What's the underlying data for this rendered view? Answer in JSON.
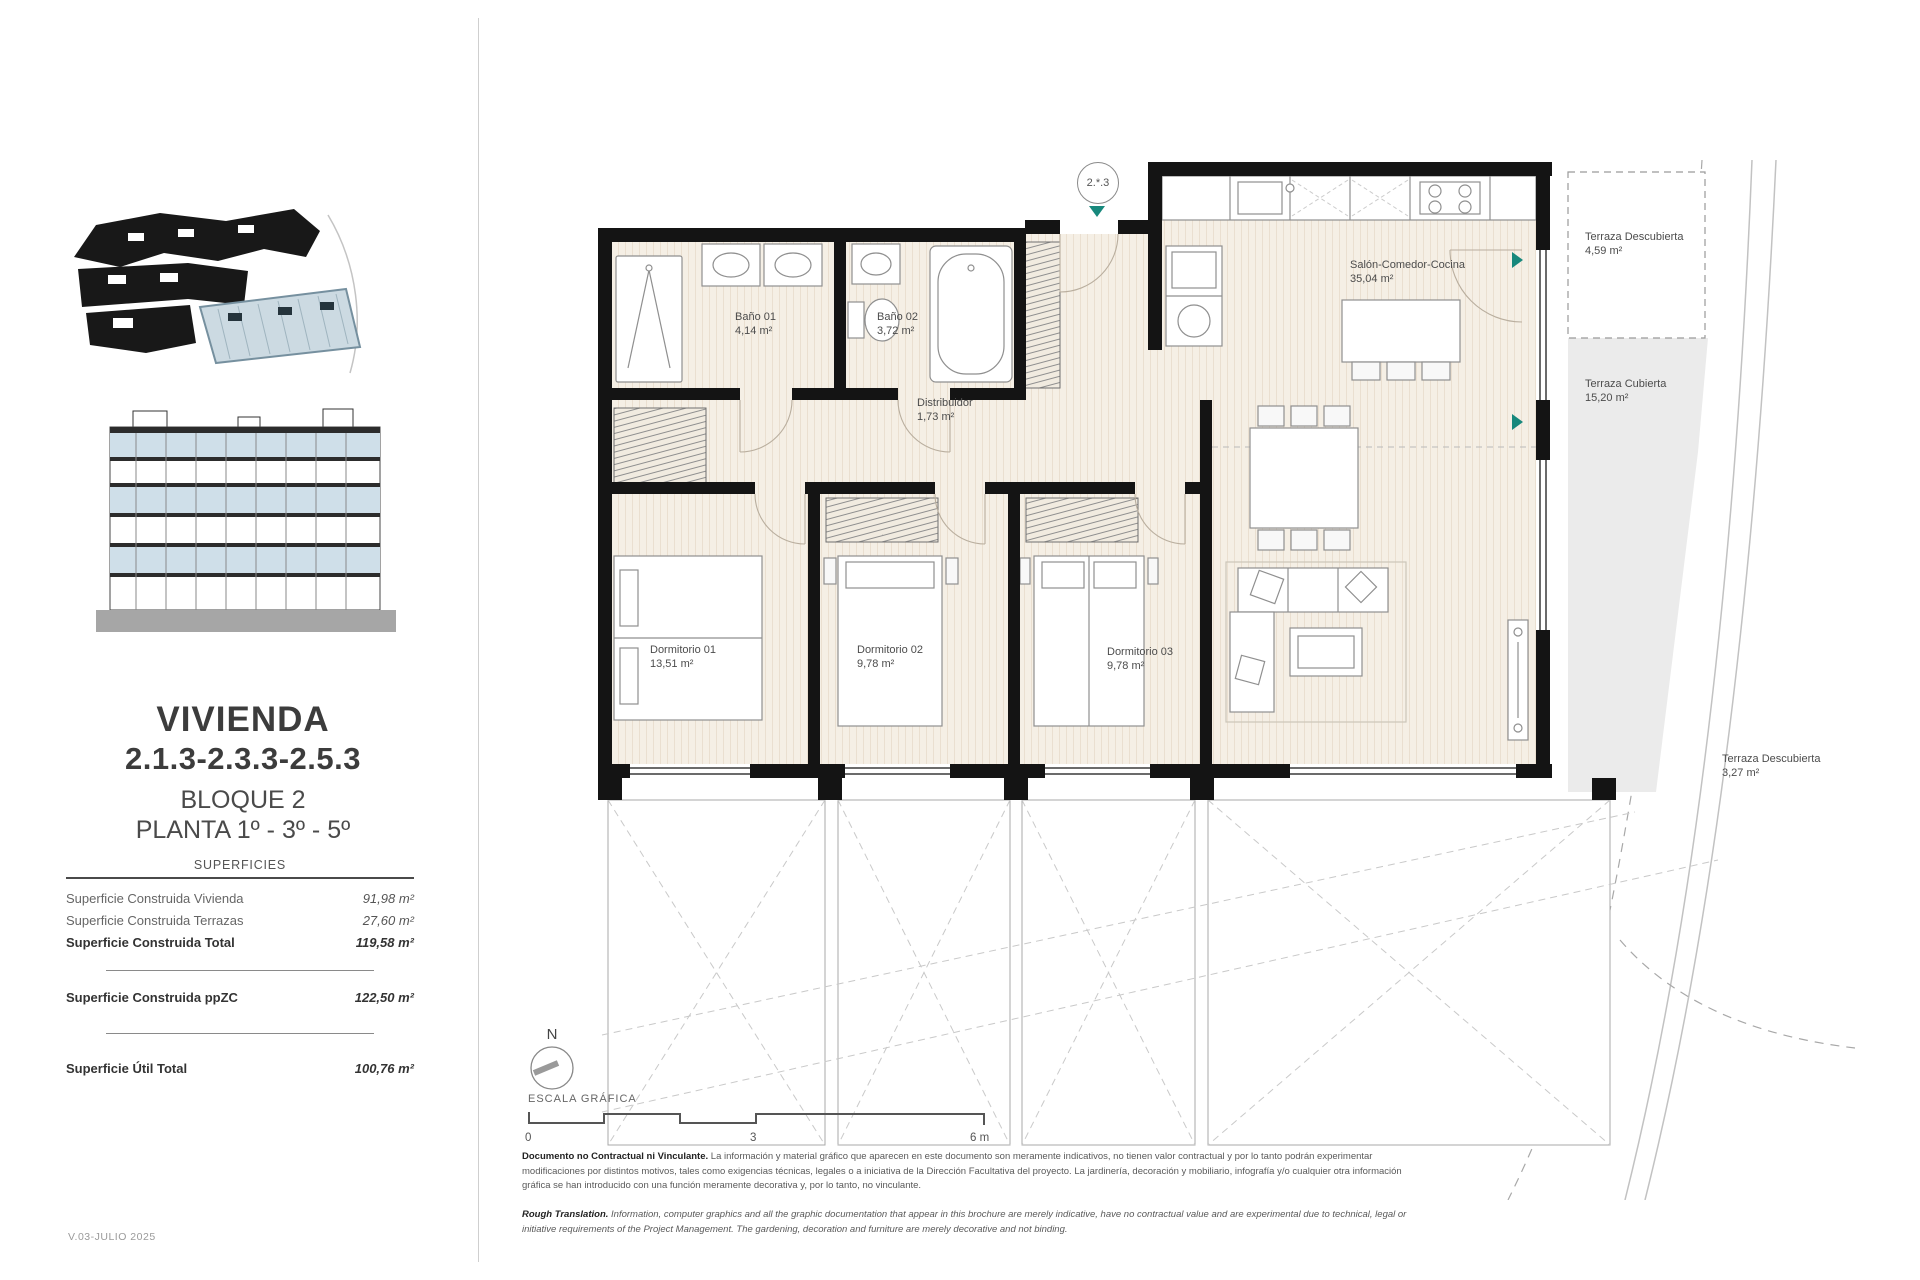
{
  "document": {
    "version": "V.03-JULIO 2025"
  },
  "sidebar": {
    "title": "VIVIENDA",
    "unit_numbers": "2.1.3-2.3.3-2.5.3",
    "block": "BLOQUE 2",
    "floors": "PLANTA 1º - 3º - 5º",
    "surfaces": {
      "heading": "SUPERFICIES",
      "rows": [
        {
          "label": "Superficie Construida Vivienda",
          "value": "91,98 m²"
        },
        {
          "label": "Superficie Construida Terrazas",
          "value": "27,60 m²"
        },
        {
          "label": "Superficie Construida Total",
          "value": "119,58 m²"
        },
        {
          "label": "Superficie Construida ppZC",
          "value": "122,50 m²"
        },
        {
          "label": "Superficie Útil Total",
          "value": "100,76 m²"
        }
      ]
    }
  },
  "plan": {
    "unit_marker": "2.*.3",
    "rooms": [
      {
        "name": "Baño 01",
        "area": "4,14 m²"
      },
      {
        "name": "Baño 02",
        "area": "3,72 m²"
      },
      {
        "name": "Distribuidor",
        "area": "1,73 m²"
      },
      {
        "name": "Salón-Comedor-Cocina",
        "area": "35,04 m²"
      },
      {
        "name": "Dormitorio 01",
        "area": "13,51 m²"
      },
      {
        "name": "Dormitorio 02",
        "area": "9,78 m²"
      },
      {
        "name": "Dormitorio 03",
        "area": "9,78 m²"
      },
      {
        "name": "Terraza Descubierta",
        "area": "4,59 m²"
      },
      {
        "name": "Terraza Cubierta",
        "area": "15,20 m²"
      },
      {
        "name": "Terraza Descubierta",
        "area": "3,27 m²"
      }
    ]
  },
  "compass": {
    "north_label": "N"
  },
  "scale_bar": {
    "label": "ESCALA GRÁFICA",
    "ticks": [
      "0",
      "3",
      "6 m"
    ]
  },
  "footer": {
    "disclaimer_lead": "Documento no Contractual ni Vinculante.",
    "disclaimer_text": "La información y material gráfico que aparecen en este documento son meramente indicativos, no tienen valor contractual y por lo tanto podrán experimentar modificaciones por distintos motivos, tales como exigencias técnicas, legales o a iniciativa de la Dirección Facultativa del proyecto. La jardinería, decoración y mobiliario, infografía y/o cualquier otra información gráfica se han introducido con una función meramente decorativa y, por lo tanto, no vinculante.",
    "translation_lead": "Rough Translation.",
    "translation_text": "Information, computer graphics and all the graphic documentation that appear in this brochure are merely indicative, have no contractual value and are experimental due to technical, legal or initiative requirements of the Project Management. The gardening, decoration and furniture are merely decorative and not binding."
  }
}
